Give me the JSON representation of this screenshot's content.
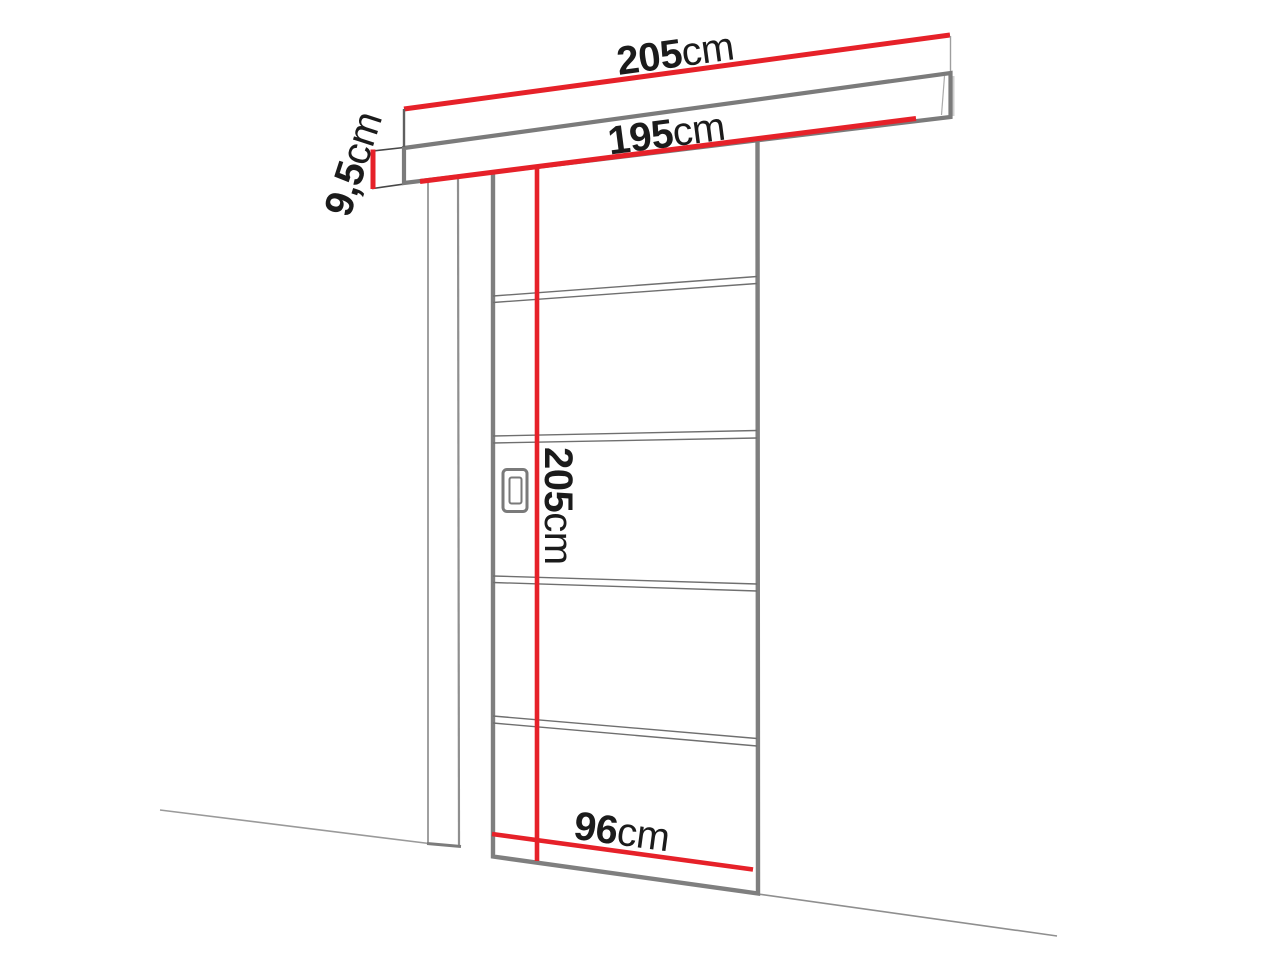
{
  "diagram": {
    "description": "Sliding door with wall-mounted track, dimension drawing",
    "labels": {
      "track_total_width": {
        "value": "205",
        "unit": "cm"
      },
      "track_inner_width": {
        "value": "195",
        "unit": "cm"
      },
      "track_height": {
        "value": "9,5",
        "unit": "cm"
      },
      "door_height": {
        "value": "205",
        "unit": "cm"
      },
      "door_width": {
        "value": "96",
        "unit": "cm"
      }
    },
    "colors": {
      "dimension_line": "#e62129",
      "outline_gray": "#7d7d7d",
      "sketch_line": "#6f6f6f",
      "wall_line": "#8f8f8f",
      "label_text": "#1b1b1b",
      "background": "#ffffff"
    }
  }
}
